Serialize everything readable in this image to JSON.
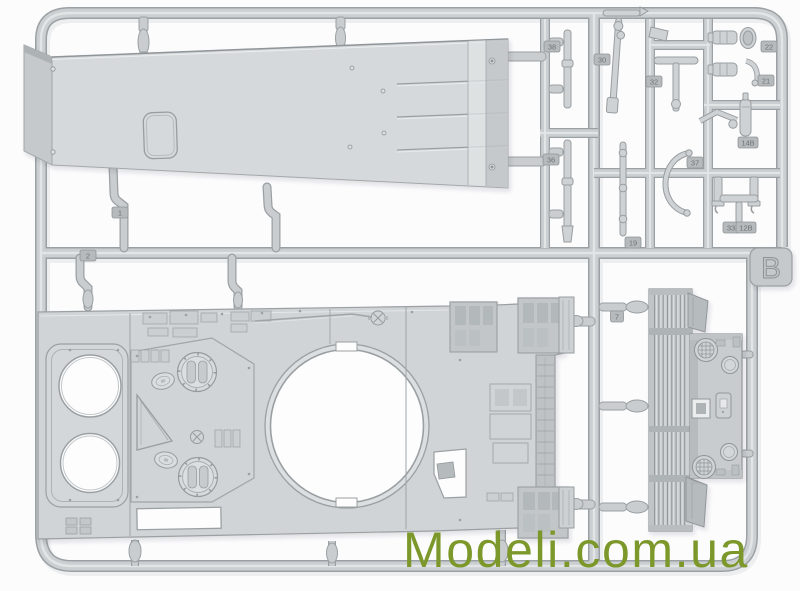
{
  "watermark": {
    "text": "Modeli.com.ua",
    "color": "#7d982a"
  },
  "sprue": {
    "letter_tab": {
      "label": "B"
    },
    "material_colors": {
      "plastic": "#ced2d4",
      "runner": "#c9cdcf",
      "edge_shadow": "#9aa0a3",
      "hole_background": "#fdfdfe",
      "background": "#fcfcfd"
    },
    "part_tags": [
      {
        "label": "1"
      },
      {
        "label": "2"
      },
      {
        "label": "38"
      },
      {
        "label": "30"
      },
      {
        "label": "32"
      },
      {
        "label": "36"
      },
      {
        "label": "19"
      },
      {
        "label": "22"
      },
      {
        "label": "21"
      },
      {
        "label": "14B"
      },
      {
        "label": "37"
      },
      {
        "label": "33"
      },
      {
        "label": "12B"
      },
      {
        "label": "7"
      }
    ],
    "parts": [
      {
        "name": "hull-belly-plate"
      },
      {
        "name": "upper-hull-deck"
      },
      {
        "name": "engine-grille-louver"
      },
      {
        "name": "rear-access-plate"
      },
      {
        "name": "tool-rods"
      },
      {
        "name": "headlights"
      },
      {
        "name": "fire-extinguisher"
      },
      {
        "name": "periscopes"
      },
      {
        "name": "tow-clamp"
      }
    ]
  }
}
